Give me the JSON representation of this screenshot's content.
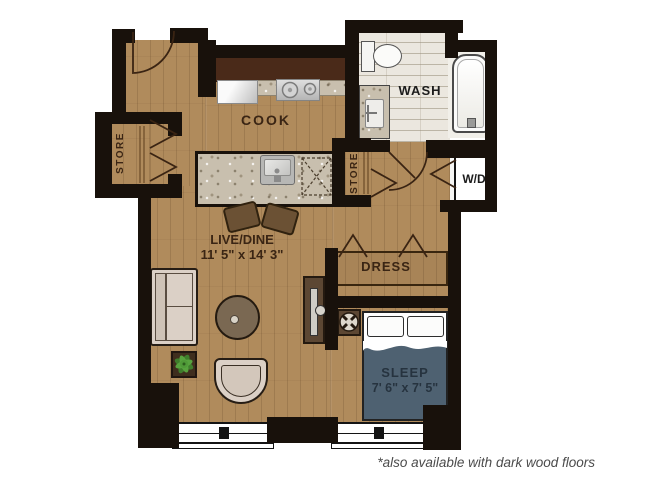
{
  "floorplan": {
    "title": "studio-apartment-floor-plan",
    "rooms": {
      "cook": {
        "label": "COOK"
      },
      "wash": {
        "label": "WASH"
      },
      "live_dine": {
        "label": "LIVE/DINE",
        "dimensions": "11' 5\" x 14' 3\""
      },
      "dress": {
        "label": "DRESS"
      },
      "sleep": {
        "label": "SLEEP",
        "dimensions": "7' 6\" x 7' 5\""
      },
      "store_left": {
        "label": "STORE"
      },
      "store_center": {
        "label": "STORE"
      },
      "washer_dryer": {
        "label": "W/D"
      }
    },
    "footnote": "*also available with dark wood floors",
    "colors": {
      "wood_floor": "#b08b5c",
      "wall": "#18110b",
      "cabinets": "#4a2a19",
      "granite": "#c8bfae",
      "tile": "#ebe7df",
      "bed_blanket": "#4e6171",
      "label_text": "#3a2514",
      "sleep_text": "#26333f",
      "footnote_text": "#4b4b4b",
      "plant_green": "#4f9a38"
    }
  }
}
